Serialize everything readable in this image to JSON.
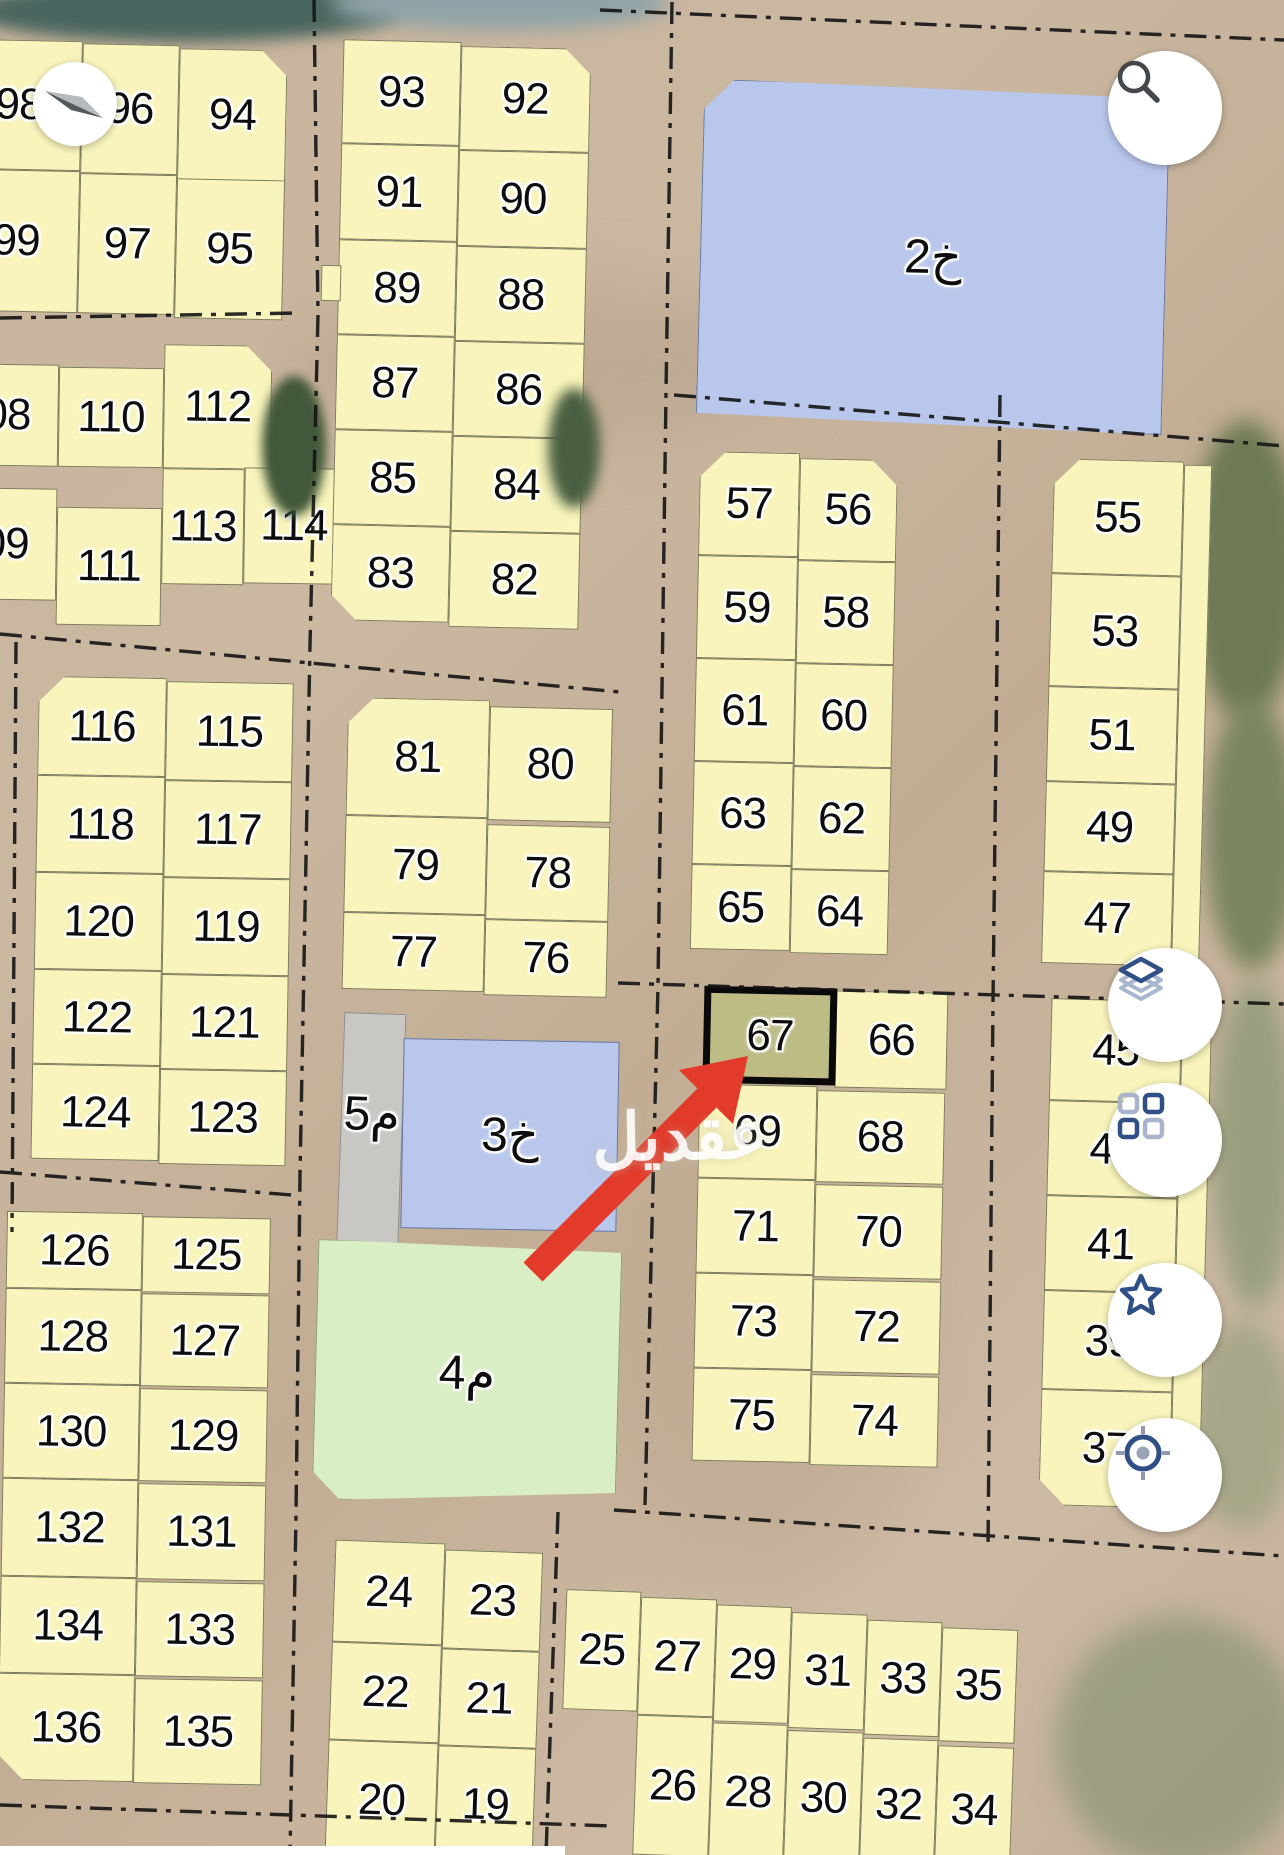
{
  "plots": {
    "19": "19",
    "20": "20",
    "21": "21",
    "22": "22",
    "23": "23",
    "24": "24",
    "25": "25",
    "26": "26",
    "27": "27",
    "28": "28",
    "29": "29",
    "30": "30",
    "31": "31",
    "32": "32",
    "33": "33",
    "34": "34",
    "35": "35",
    "37": "37",
    "39": "39",
    "41": "41",
    "43": "43",
    "45": "45",
    "47": "47",
    "49": "49",
    "51": "51",
    "53": "53",
    "55": "55",
    "56": "56",
    "57": "57",
    "58": "58",
    "59": "59",
    "60": "60",
    "61": "61",
    "62": "62",
    "63": "63",
    "64": "64",
    "65": "65",
    "66": "66",
    "67": "67",
    "68": "68",
    "69": "69",
    "70": "70",
    "71": "71",
    "72": "72",
    "73": "73",
    "74": "74",
    "75": "75",
    "76": "76",
    "77": "77",
    "78": "78",
    "79": "79",
    "80": "80",
    "81": "81",
    "82": "82",
    "83": "83",
    "84": "84",
    "85": "85",
    "86": "86",
    "87": "87",
    "88": "88",
    "89": "89",
    "90": "90",
    "91": "91",
    "92": "92",
    "93": "93",
    "94": "94",
    "95": "95",
    "96": "96",
    "97": "97",
    "98": "98",
    "99": "99",
    "108": "08",
    "109": "09",
    "110": "110",
    "111": "111",
    "112": "112",
    "113": "113",
    "114": "114",
    "115": "115",
    "116": "116",
    "117": "117",
    "118": "118",
    "119": "119",
    "120": "120",
    "121": "121",
    "122": "122",
    "123": "123",
    "124": "124",
    "125": "125",
    "126": "126",
    "127": "127",
    "128": "128",
    "129": "129",
    "130": "130",
    "131": "131",
    "132": "132",
    "133": "133",
    "134": "134",
    "135": "135",
    "136": "136",
    "kh2": "خ2",
    "kh3": "خ3",
    "m4": "م4",
    "m5": "م5"
  },
  "annotations": {
    "highlighted_plot": "67",
    "arrow_color": "#e23a2b",
    "highlight_fill": "#bdbc85"
  },
  "watermark": {
    "text": "عقديل"
  },
  "icons": {
    "search": "search-icon",
    "layers": "layers-icon",
    "grid": "grid-icon",
    "star": "star-icon",
    "locate": "locate-icon",
    "compass": "compass-icon"
  },
  "colors": {
    "plot": "#f8f4bb",
    "commercial_blue": "#b9c7ec",
    "garden_green": "#daeec6",
    "utility_gray": "#c9c7c3"
  }
}
